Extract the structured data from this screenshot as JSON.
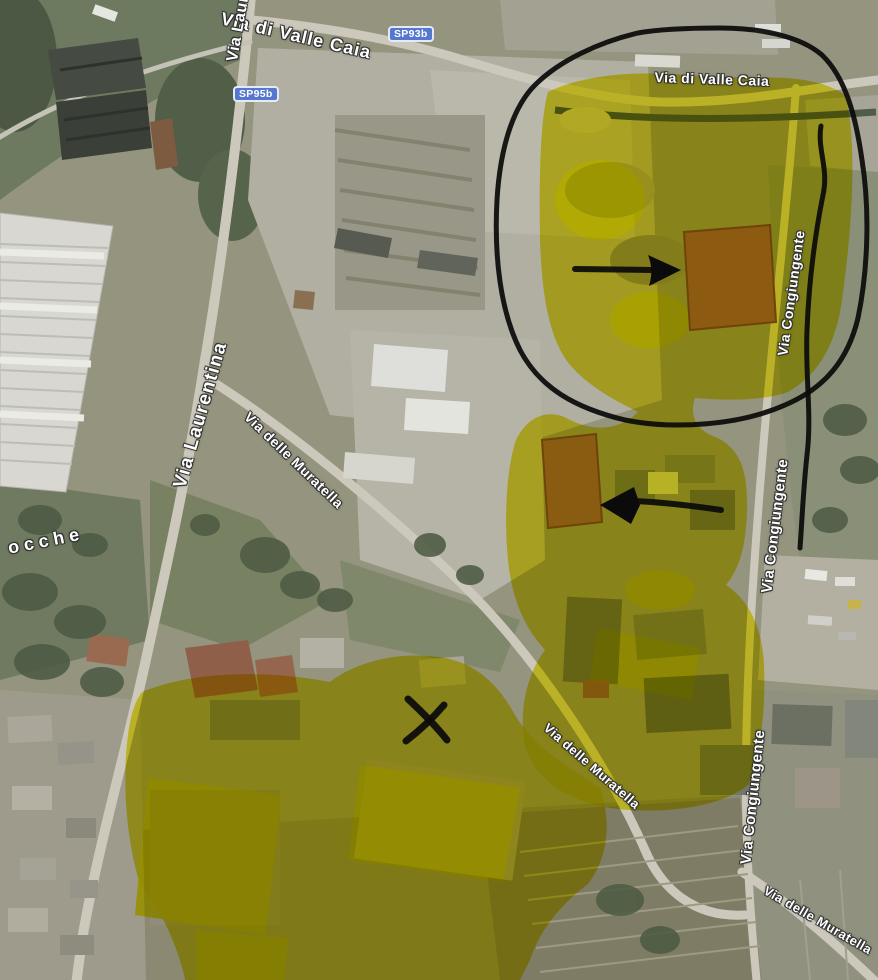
{
  "map": {
    "type": "satellite-annotated",
    "road_labels": [
      {
        "id": "valle-caia-top",
        "text": "Via di Valle Caia"
      },
      {
        "id": "laurentina-top",
        "text": "Via Laurentina"
      },
      {
        "id": "valle-caia-right",
        "text": "Via di Valle Caia"
      },
      {
        "id": "laurentina-mid",
        "text": "Via Laurentina"
      },
      {
        "id": "muratella-mid",
        "text": "Via delle Muratella"
      },
      {
        "id": "congiungente-upper",
        "text": "Via Congiungente"
      },
      {
        "id": "congiungente-mid",
        "text": "Via Congiungente"
      },
      {
        "id": "muratella-lower",
        "text": "Via delle Muratella"
      },
      {
        "id": "congiungente-lower",
        "text": "Via Congiungente"
      },
      {
        "id": "muratella-bottom",
        "text": "Via delle Muratella"
      },
      {
        "id": "left-edge-partial",
        "text": "ocche"
      }
    ],
    "route_badges": [
      {
        "id": "sp93b",
        "text": "SP93b"
      },
      {
        "id": "sp95b",
        "text": "SP95b"
      }
    ],
    "colors": {
      "highlight_yellow": "#e3da00",
      "ink_annotation": "#0b0b0b",
      "badge_blue": "#5577cd",
      "label_text": "#ffffff"
    },
    "ink_annotations": [
      {
        "id": "freehand-loop",
        "desc": "hand-drawn loop circling the upper-right highlighted site"
      },
      {
        "id": "vertical-line",
        "desc": "wavy vertical line inside loop along Via Congiungente"
      },
      {
        "id": "arrow-right",
        "desc": "arrow pointing right at brown-roof building"
      },
      {
        "id": "arrow-left",
        "desc": "arrow pointing left at brown-roof building"
      },
      {
        "id": "x-mark",
        "desc": "X mark over building in lower-left highlighted area"
      }
    ]
  }
}
